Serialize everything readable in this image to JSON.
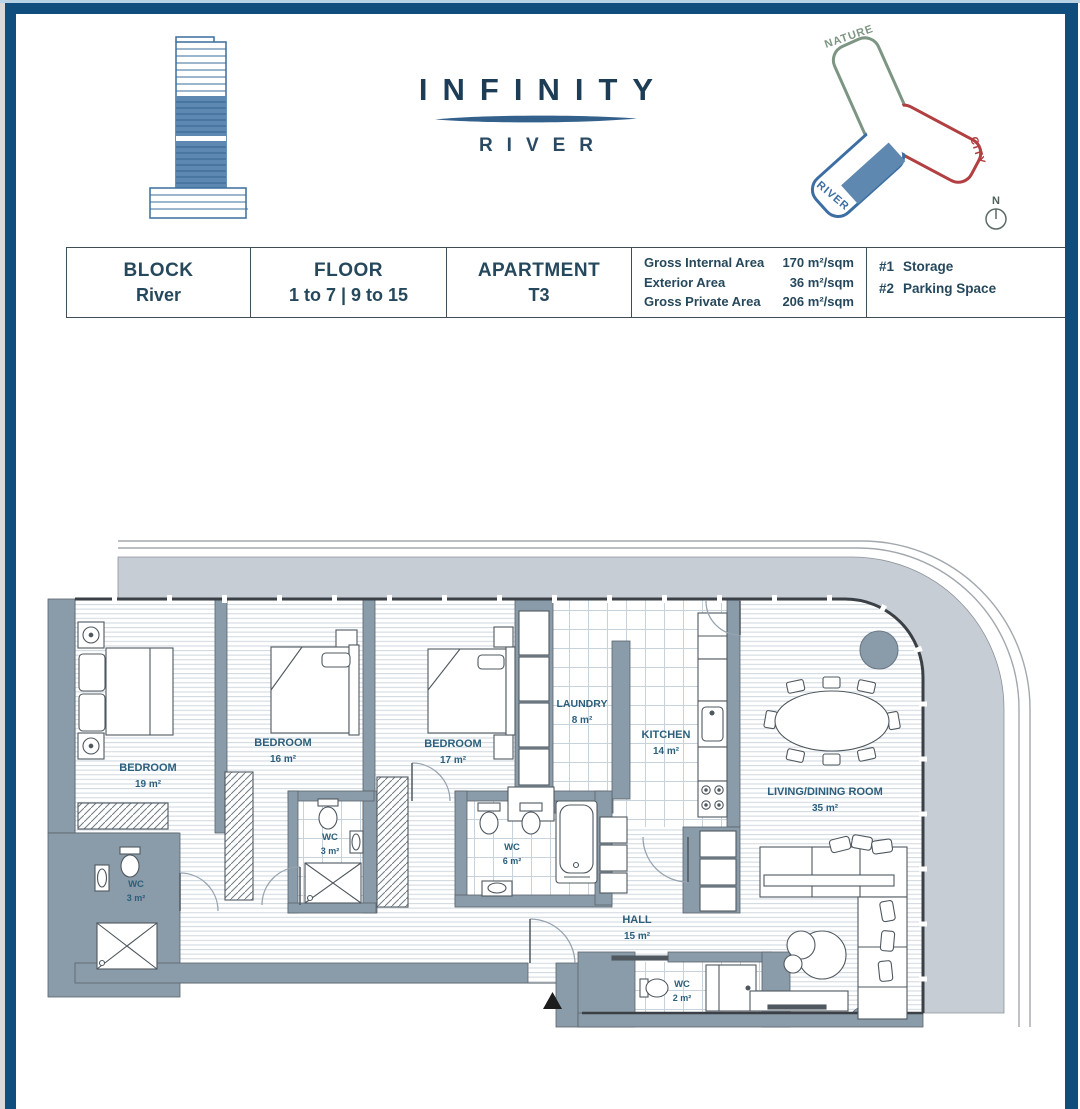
{
  "page": {
    "frame_color": "#0f4e7c",
    "accent_color": "#b9d3e6"
  },
  "brand": {
    "title": "INFINITY",
    "subtitle": "RIVER"
  },
  "site_diagram": {
    "nature_label": "NATURE",
    "city_label": "CITY",
    "river_label": "RIVER",
    "compass_label": "N",
    "nature_color": "#7d9583",
    "city_color": "#b23f42",
    "river_color": "#3d6ea3",
    "apartment_fill": "#5f88b0"
  },
  "info_table": {
    "cells": [
      {
        "label": "BLOCK",
        "value": "River"
      },
      {
        "label": "FLOOR",
        "value": "1 to 7 | 9 to 15"
      },
      {
        "label": "APARTMENT",
        "value": "T3"
      }
    ],
    "areas": [
      {
        "label": "Gross Internal Area",
        "value": "170 m²/sqm"
      },
      {
        "label": "Exterior Area",
        "value": "36 m²/sqm"
      },
      {
        "label": "Gross Private Area",
        "value": "206 m²/sqm"
      }
    ],
    "extras": [
      {
        "num": "#1",
        "label": "Storage"
      },
      {
        "num": "#2",
        "label": "Parking Space"
      }
    ]
  },
  "floor_plan": {
    "rooms": [
      {
        "name": "BEDROOM",
        "area": "19 m²"
      },
      {
        "name": "BEDROOM",
        "area": "16 m²"
      },
      {
        "name": "BEDROOM",
        "area": "17 m²"
      },
      {
        "name": "LAUNDRY",
        "area": "8 m²"
      },
      {
        "name": "KITCHEN",
        "area": "14 m²"
      },
      {
        "name": "LIVING/DINING ROOM",
        "area": "35 m²"
      },
      {
        "name": "WC",
        "area": "3 m²"
      },
      {
        "name": "WC",
        "area": "3 m²"
      },
      {
        "name": "WC",
        "area": "6 m²"
      },
      {
        "name": "HALL",
        "area": "15 m²"
      },
      {
        "name": "WC",
        "area": "2 m²"
      }
    ]
  }
}
